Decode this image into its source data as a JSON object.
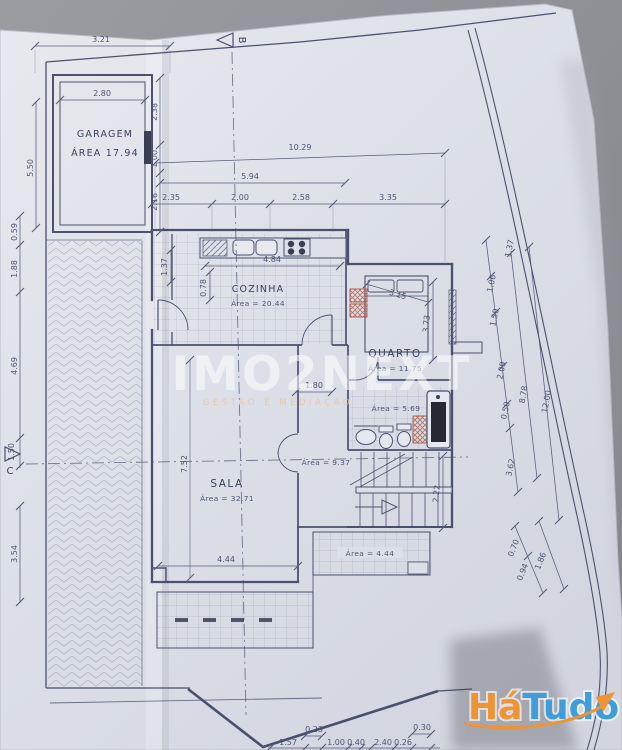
{
  "photo": {
    "background_color": "#909298",
    "paper_color": "#dde0e8",
    "line_color": "#3e4565"
  },
  "branding": {
    "watermark_title": "IMO2NEXT",
    "watermark_subtitle": "GESTÃO E MEDIAÇÃO",
    "logo_part1": "Há",
    "logo_part2": "Tudo",
    "logo_color1": "#ef9434",
    "logo_color2": "#3f9ed8"
  },
  "section_markers": {
    "b": "B",
    "c": "C"
  },
  "rooms": {
    "garagem": {
      "name": "GARAGEM",
      "area": "ÁREA  17.94"
    },
    "cozinha": {
      "name": "COZINHA",
      "area": "Área = 20.44"
    },
    "quarto": {
      "name": "QUARTO",
      "area": "Área = 11.75"
    },
    "sala": {
      "name": "SALA",
      "area": "Área = 32.71"
    },
    "hall": {
      "area": "Área = 9.37"
    },
    "banho": {
      "area": "Área = 5.69"
    },
    "terraco": {
      "area": "Área = 4.44"
    }
  },
  "dims": {
    "garage_top": "3.21",
    "garage_inner": "2.80",
    "garage_left": "5.50",
    "right_of_garage_1": "2.38",
    "right_of_garage_2": "1.00",
    "right_of_garage_3": "2.16",
    "overall_top": "10.29",
    "top_mid": "5.94",
    "chain_1": "2.35",
    "chain_2": "2.00",
    "chain_3": "2.58",
    "chain_4": "3.35",
    "kitchen_width": "4.84",
    "kitchen_left": "0.78",
    "entry_v": "1.37",
    "bed_diag": "3.15",
    "quarto_height": "3.73",
    "left_1": "0.59",
    "left_2": "1.88",
    "left_3": "4.69",
    "left_4": "1.50",
    "left_5": "3.54",
    "hall_w": "1.80",
    "stairs_h": "2.22",
    "sala_w": "4.44",
    "sala_h": "7.52",
    "right_0": "1.37",
    "right_1": "1.06",
    "right_2": "1.50",
    "right_3": "2.09",
    "right_4": "0.50",
    "right_5": "3.62",
    "right_total_1": "8.78",
    "right_total_2": "12.00",
    "br_1": "0.70",
    "br_2": "0.94",
    "br_3": "1.86",
    "bottom_1": "1.57",
    "bottom_2": "0.23",
    "bottom_3": "1.00",
    "bottom_4": "0.40",
    "bottom_5": "2.40",
    "bottom_6": "0.26",
    "bottom_7": "0.30"
  }
}
